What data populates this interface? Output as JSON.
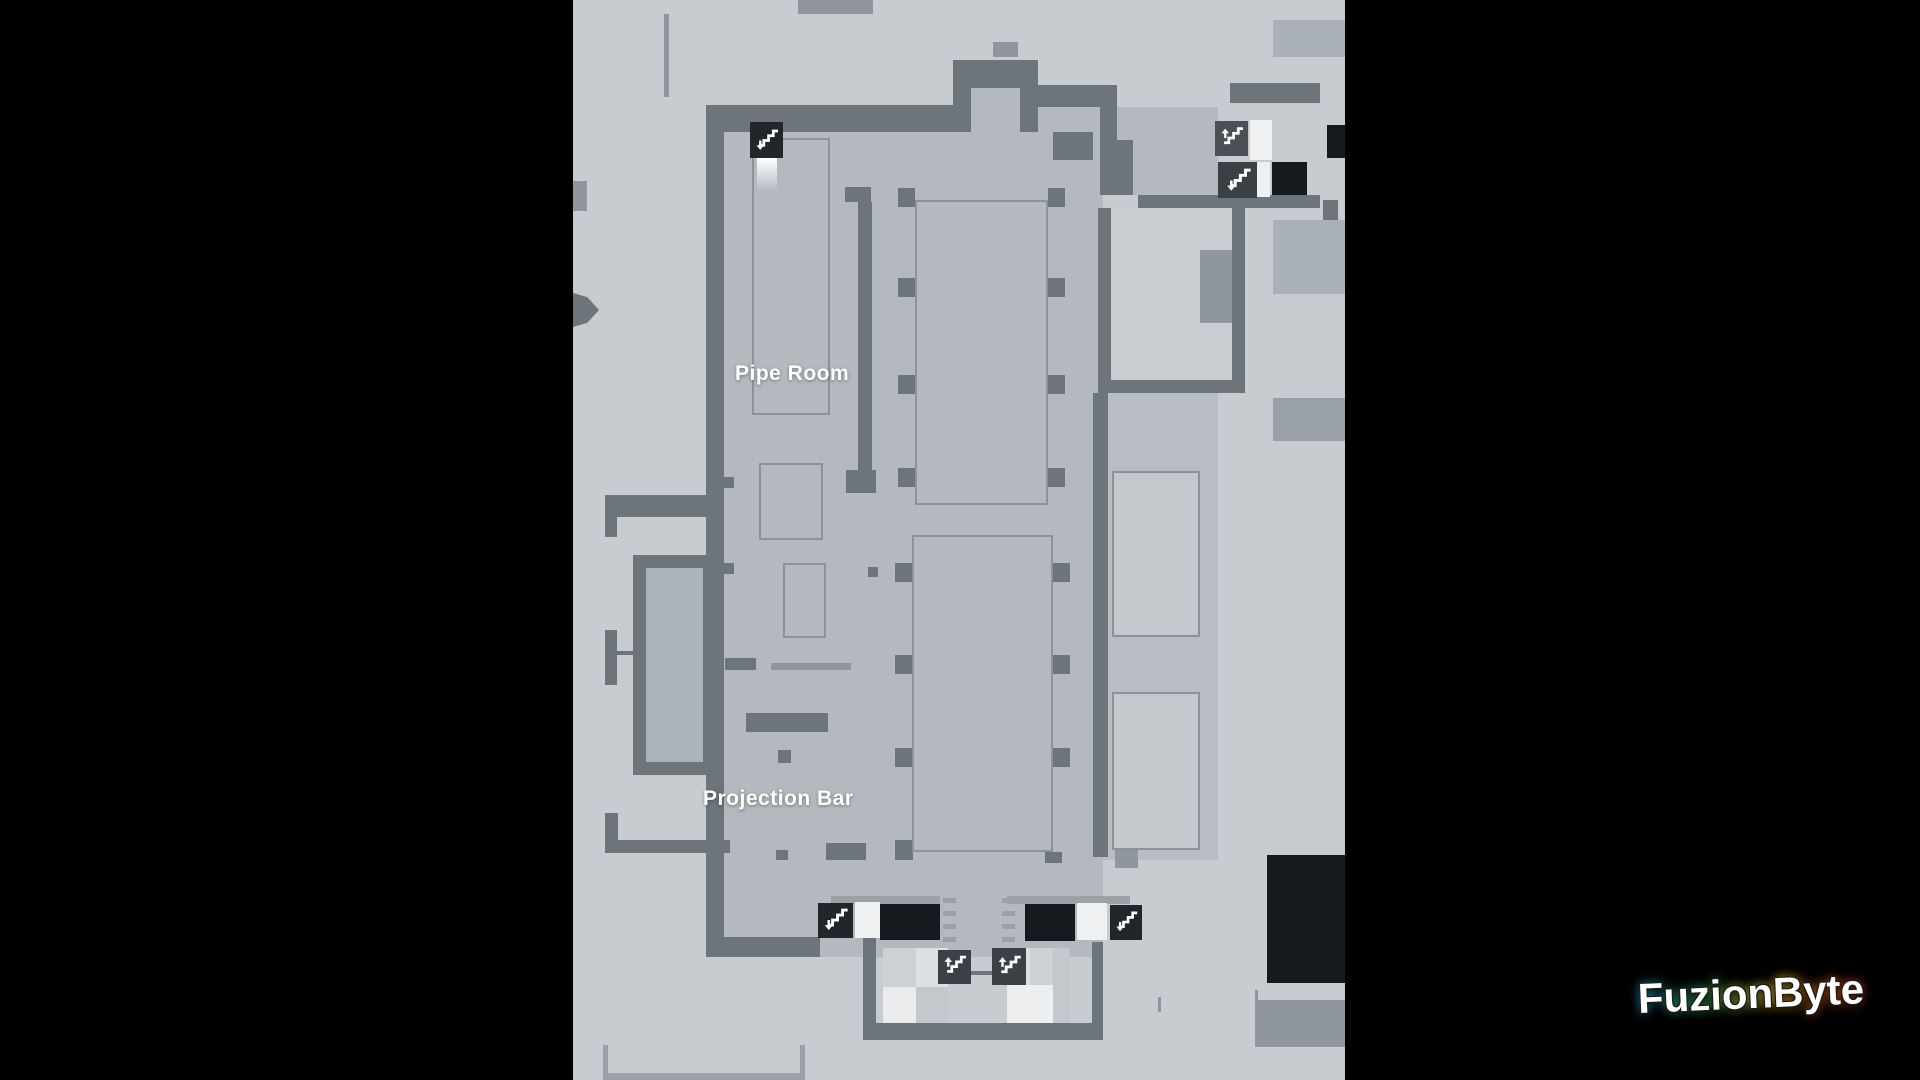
{
  "map": {
    "labels": {
      "pipe_room": "Pipe Room",
      "projection_bar": "Projection Bar"
    },
    "icons": [
      {
        "name": "stairs-down-icon",
        "location": "top-left-escalator"
      },
      {
        "name": "stairs-up-icon",
        "location": "top-right-upper"
      },
      {
        "name": "stairs-down-icon",
        "location": "top-right-lower"
      },
      {
        "name": "stairs-down-icon",
        "location": "bottom-left-escalator"
      },
      {
        "name": "stairs-down-icon",
        "location": "bottom-right-escalator"
      },
      {
        "name": "stairs-up-icon",
        "location": "bottom-center-left"
      },
      {
        "name": "stairs-up-icon",
        "location": "bottom-center-right"
      }
    ],
    "colors": {
      "outer_floor": "#c8ccd0",
      "interior_floor": "#b3b9be",
      "wall": "#6d757c",
      "room_outline": "#8b9298",
      "light_room": "#c9cdd1",
      "icon_dark": "#22262a",
      "tile_white": "#eff0f1",
      "tile_black": "#16191d",
      "label_text": "#ffffff"
    }
  },
  "watermark": {
    "text": "FuzionByte",
    "glow_colors": [
      "#2bb1ff",
      "#39d353",
      "#ffe12b",
      "#ff8a00",
      "#ff3b30"
    ]
  }
}
